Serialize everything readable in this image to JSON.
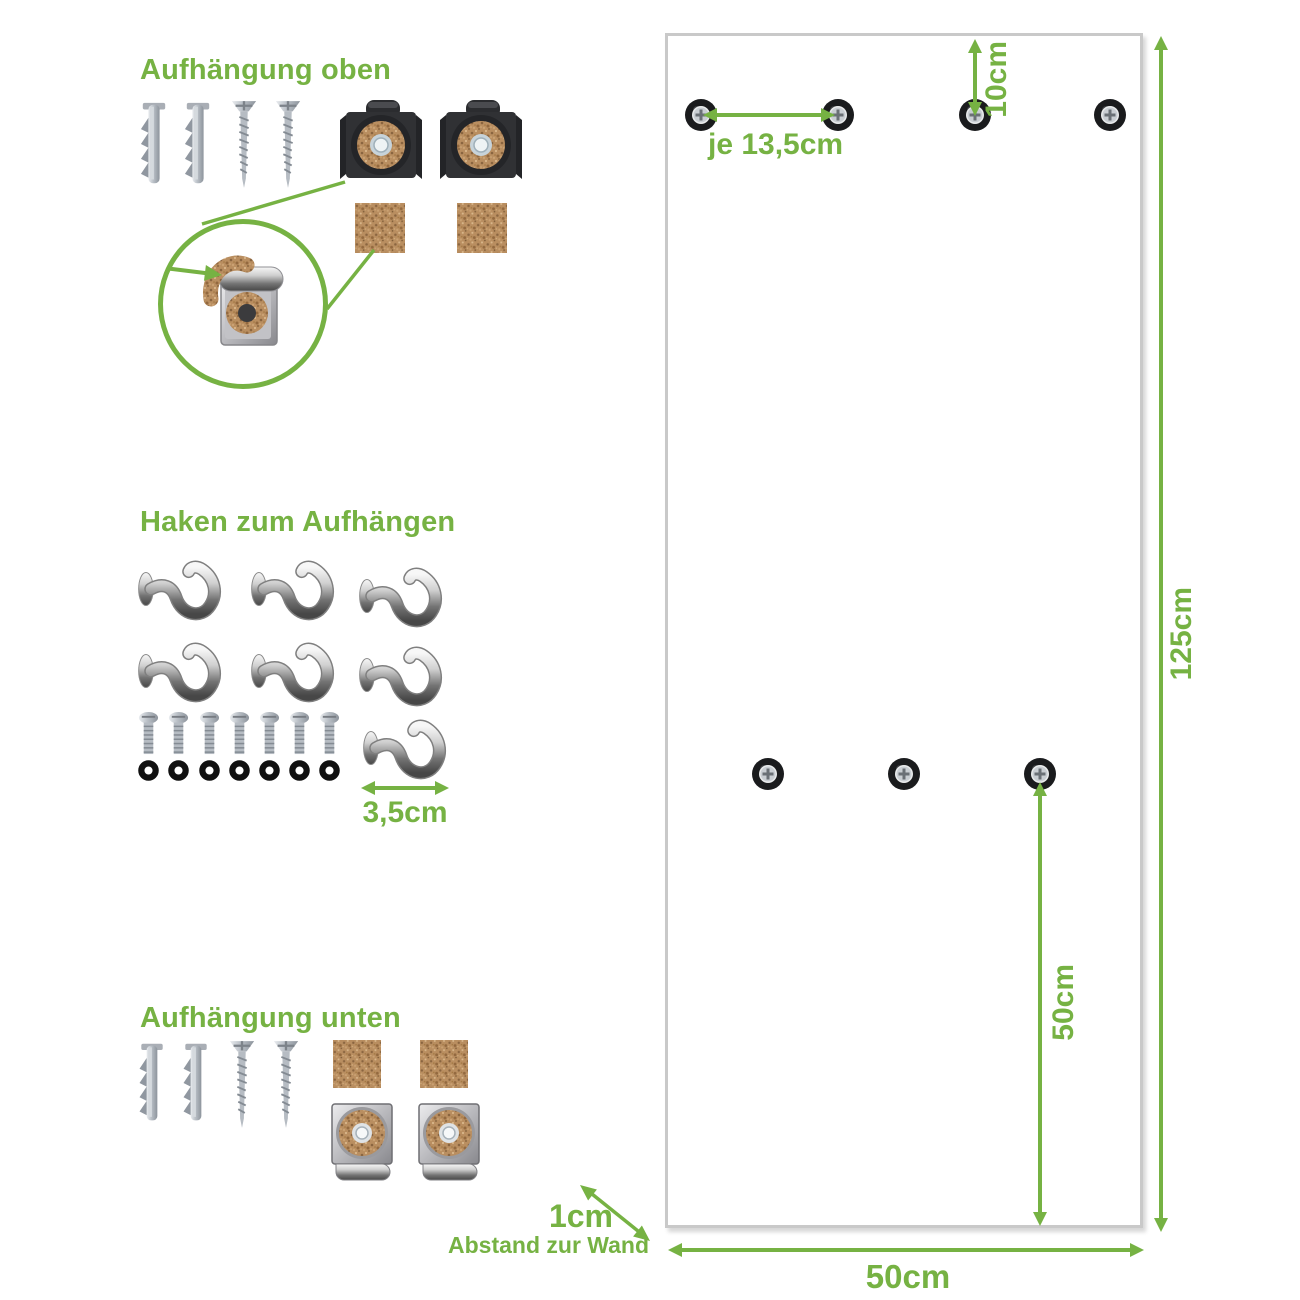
{
  "sections": {
    "top_mount": {
      "title": "Aufhängung oben"
    },
    "hooks": {
      "title": "Haken zum Aufhängen",
      "hook_width": "3,5cm"
    },
    "bottom_mount": {
      "title": "Aufhängung unten"
    }
  },
  "panel": {
    "top_offset": "10cm",
    "hole_spacing": "je 13,5cm",
    "height": "125cm",
    "lower_hole_to_bottom": "50cm",
    "width": "50cm",
    "wall_distance": "1cm",
    "wall_distance_label": "Abstand zur Wand"
  },
  "colors": {
    "accent_green": "#76b243",
    "panel_border": "#c9c9c9",
    "cork": "#b98e60"
  },
  "icons": {
    "wall-plug-icon": "grey expansion wall plug",
    "screw-icon": "countersunk silver screw",
    "mounting-clip-top-icon": "dark metal clip with cork washer",
    "mounting-clip-bottom-icon": "chrome clip with cork washer and bottom lip",
    "cork-pad-icon": "square cork pad",
    "clip-detail-icon": "magnified clip with cork strip",
    "hook-icon": "chrome cup hook",
    "bolt-icon": "small machine screw",
    "washer-icon": "black rubber washer",
    "mounting-hole-icon": "drill hole with screw head",
    "dimension-arrow": "green measurement arrow"
  }
}
